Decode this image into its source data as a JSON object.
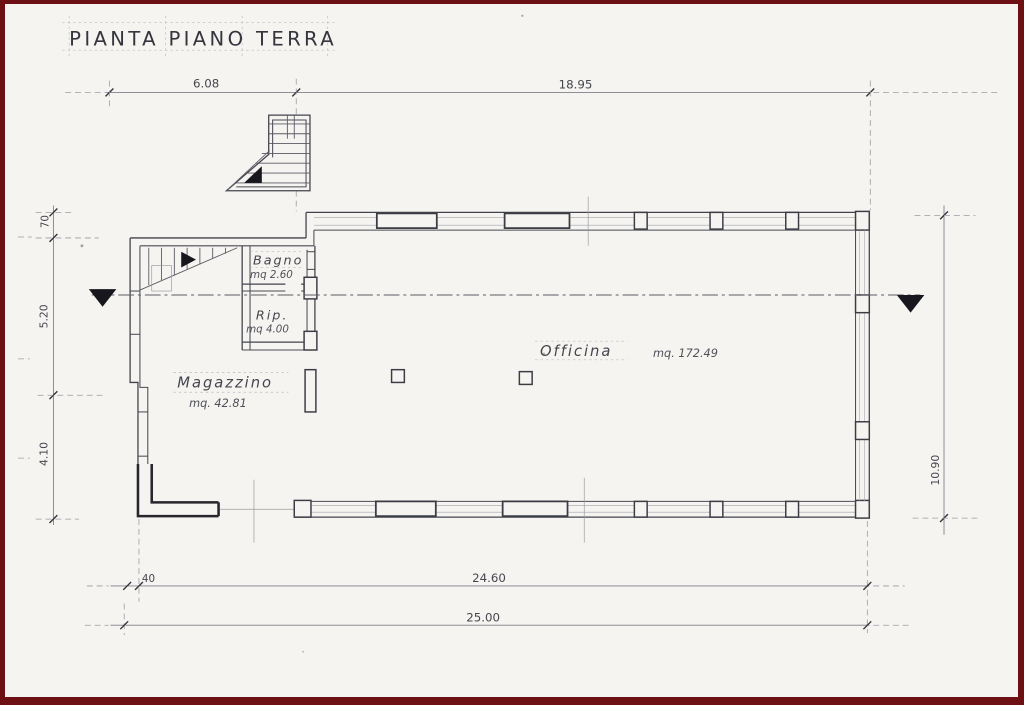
{
  "document": {
    "title": "PIANTA PIANO TERRA"
  },
  "rooms": {
    "bagno": {
      "name": "Bagno",
      "area": "mq 2.60"
    },
    "rip": {
      "name": "Rip.",
      "area": "mq 4.00"
    },
    "officina": {
      "name": "Officina",
      "area": "mq. 172.49"
    },
    "magazzino": {
      "name": "Magazzino",
      "area": "mq. 42.81"
    }
  },
  "dimensions": {
    "top_left": "6.08",
    "top_right": "18.95",
    "left_upper": "70",
    "left_middle": "5.20",
    "left_lower": "4.10",
    "right_height": "10.90",
    "bottom_offset": "40",
    "bottom_inner": "24.60",
    "bottom_total": "25.00"
  },
  "colors": {
    "paper": "#f5f4f0",
    "ink": "#3e3e48",
    "border": "#6d1014"
  }
}
